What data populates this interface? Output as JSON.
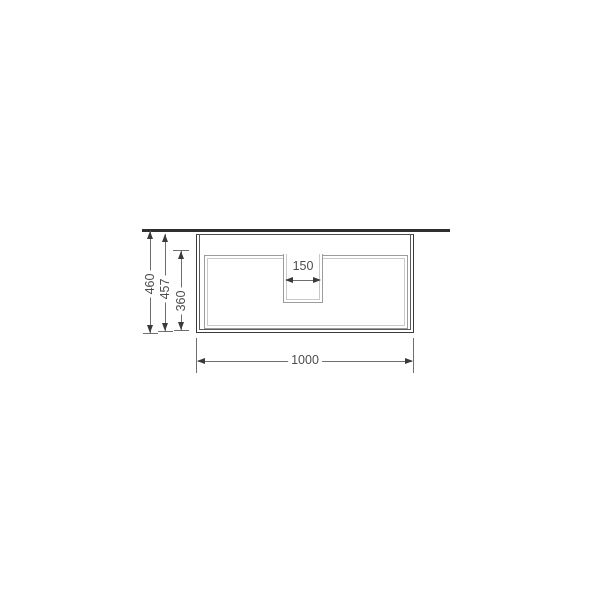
{
  "drawing": {
    "dimensions": {
      "overall_height_mm": "460",
      "carcass_height_mm": "457",
      "drawer_front_height_mm": "360",
      "cutout_width_mm": "150",
      "overall_width_mm": "1000"
    },
    "colors": {
      "outline": "#3a3a3a",
      "countertop": "#2f2f2f",
      "secondary_line": "#9c9c9c",
      "dimension_line": "#6e6e6e",
      "label_text": "#4d4d4d",
      "background": "#ffffff"
    }
  }
}
